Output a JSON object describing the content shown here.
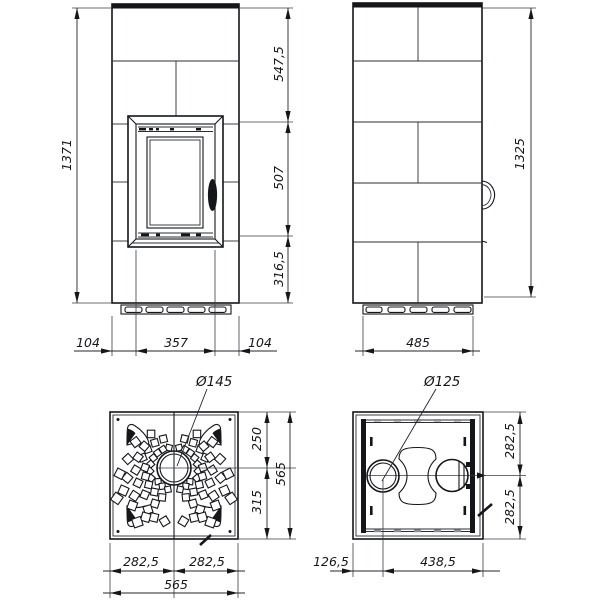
{
  "drawing_type": "stove technical drawing, four orthographic views",
  "labels": {
    "front": {
      "total_height": "1371",
      "segment_top": "547,5",
      "segment_middle": "507",
      "segment_bottom": "316,5",
      "bottom_left": "104",
      "bottom_center": "357",
      "bottom_right": "104"
    },
    "side": {
      "height": "1325",
      "base_width": "485"
    },
    "plan": {
      "flue_diameter": "Ø145",
      "offset_top": "250",
      "offset_bottom": "315",
      "depth_total": "565",
      "half_left": "282,5",
      "half_right": "282,5",
      "width_total": "565"
    },
    "section": {
      "flue_diameter": "Ø125",
      "offset_upper": "282,5",
      "offset_lower": "282,5",
      "offset_left": "126,5",
      "offset_right": "438,5"
    }
  },
  "colors": {
    "line": "#14161a",
    "background": "#ffffff"
  }
}
